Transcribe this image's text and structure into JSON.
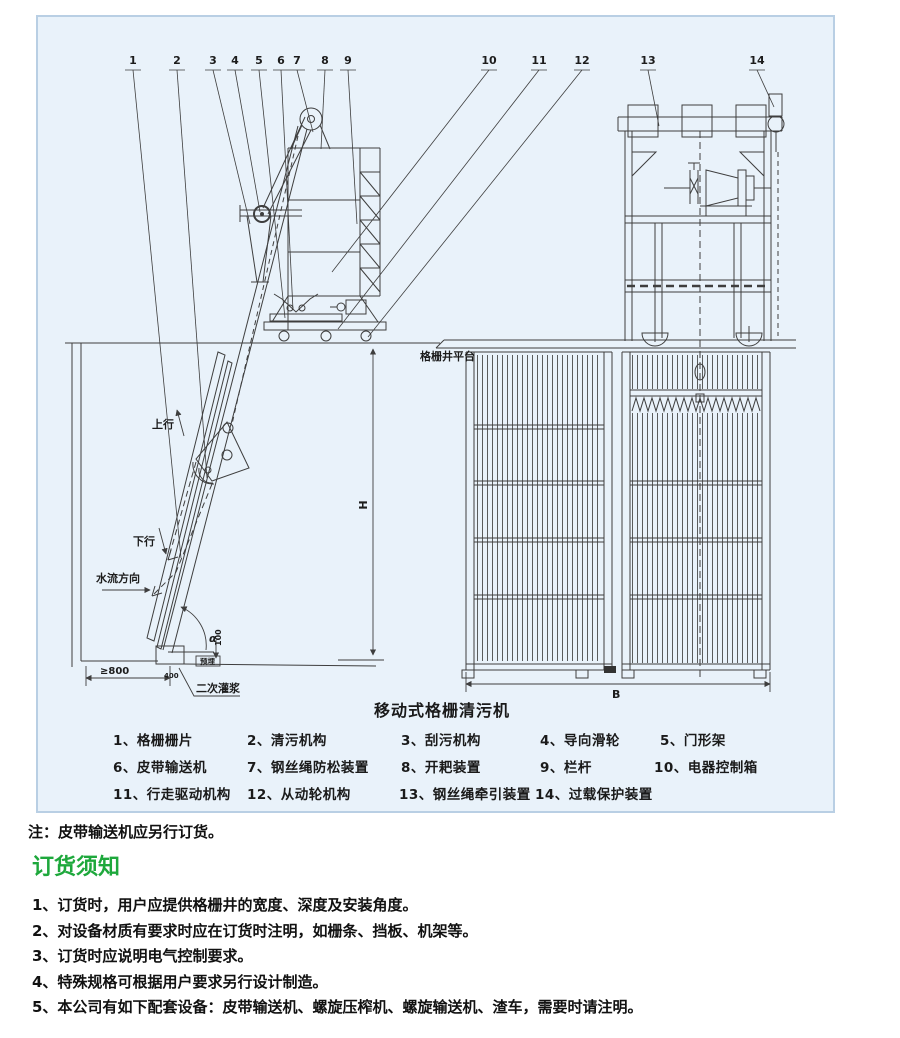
{
  "colors": {
    "panel_bg": "#e9f2fa",
    "panel_border": "#b9cfe4",
    "heading_green": "#1ea83c",
    "line": "#3e3e3e"
  },
  "diagram": {
    "title": "移动式格栅清污机",
    "callouts": [
      "1",
      "2",
      "3",
      "4",
      "5",
      "6",
      "7",
      "8",
      "9",
      "10",
      "11",
      "12",
      "13",
      "14"
    ],
    "labels": {
      "platform": "格栅井平台",
      "up": "上行",
      "down": "下行",
      "flow": "水流方向",
      "min_width": "≥800",
      "grout": "二次灌浆",
      "alpha": "α",
      "embed": "预埋",
      "dim_100": "100",
      "dim_400": "400",
      "height": "H",
      "width": "B"
    },
    "legend": {
      "rows": [
        [
          "1、格栅栅片",
          "2、清污机构",
          "3、刮污机构",
          "4、导向滑轮",
          "5、门形架"
        ],
        [
          "6、皮带输送机",
          "7、钢丝绳防松装置",
          "8、开耙装置",
          "9、栏杆",
          "10、电器控制箱"
        ],
        [
          "11、行走驱动机构",
          "12、从动轮机构",
          "13、钢丝绳牵引装置",
          "14、过载保护装置"
        ]
      ]
    }
  },
  "note": "注：皮带输送机应另行订货。",
  "ordering": {
    "heading": "订货须知",
    "items": [
      "1、订货时，用户应提供格栅井的宽度、深度及安装角度。",
      "2、对设备材质有要求时应在订货时注明，如栅条、挡板、机架等。",
      "3、订货时应说明电气控制要求。",
      "4、特殊规格可根据用户要求另行设计制造。",
      "5、本公司有如下配套设备：皮带输送机、螺旋压榨机、螺旋输送机、渣车，需要时请注明。"
    ]
  }
}
